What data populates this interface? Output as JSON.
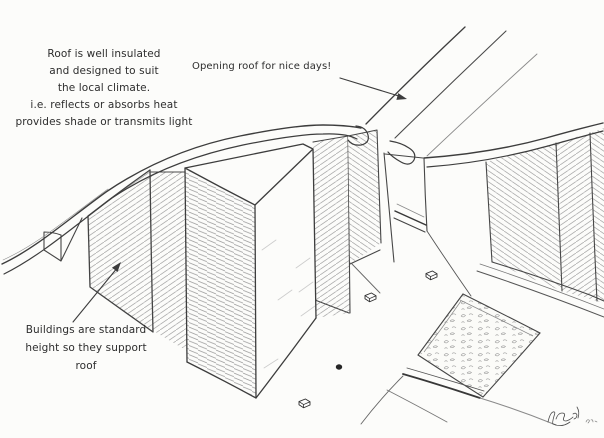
{
  "canvas": {
    "width": 604,
    "height": 438,
    "paper_color": "#fcfcfa",
    "ink_color": "#3d3d3d",
    "hatch_color": "#ababab"
  },
  "annotations": {
    "roof_note": "Roof is well insulated\nand designed to suit\nthe local climate.\ni.e. reflects or absorbs heat\nprovides shade or transmits light",
    "opening_note": "Opening roof for nice days!",
    "buildings_note": "Buildings are standard\nheight so they support\nroof"
  },
  "figure": {
    "type": "hand-drawn architectural concept sketch",
    "subject": "Curved shared roof spanning standard-height buildings, with an opening roof panel above a plaza with benches and a garden square",
    "elements": [
      "curved-roof-band",
      "opening-roof-panel",
      "tall-buildings",
      "stairs",
      "benches",
      "person",
      "garden-square",
      "walkways",
      "artist-signature"
    ]
  }
}
